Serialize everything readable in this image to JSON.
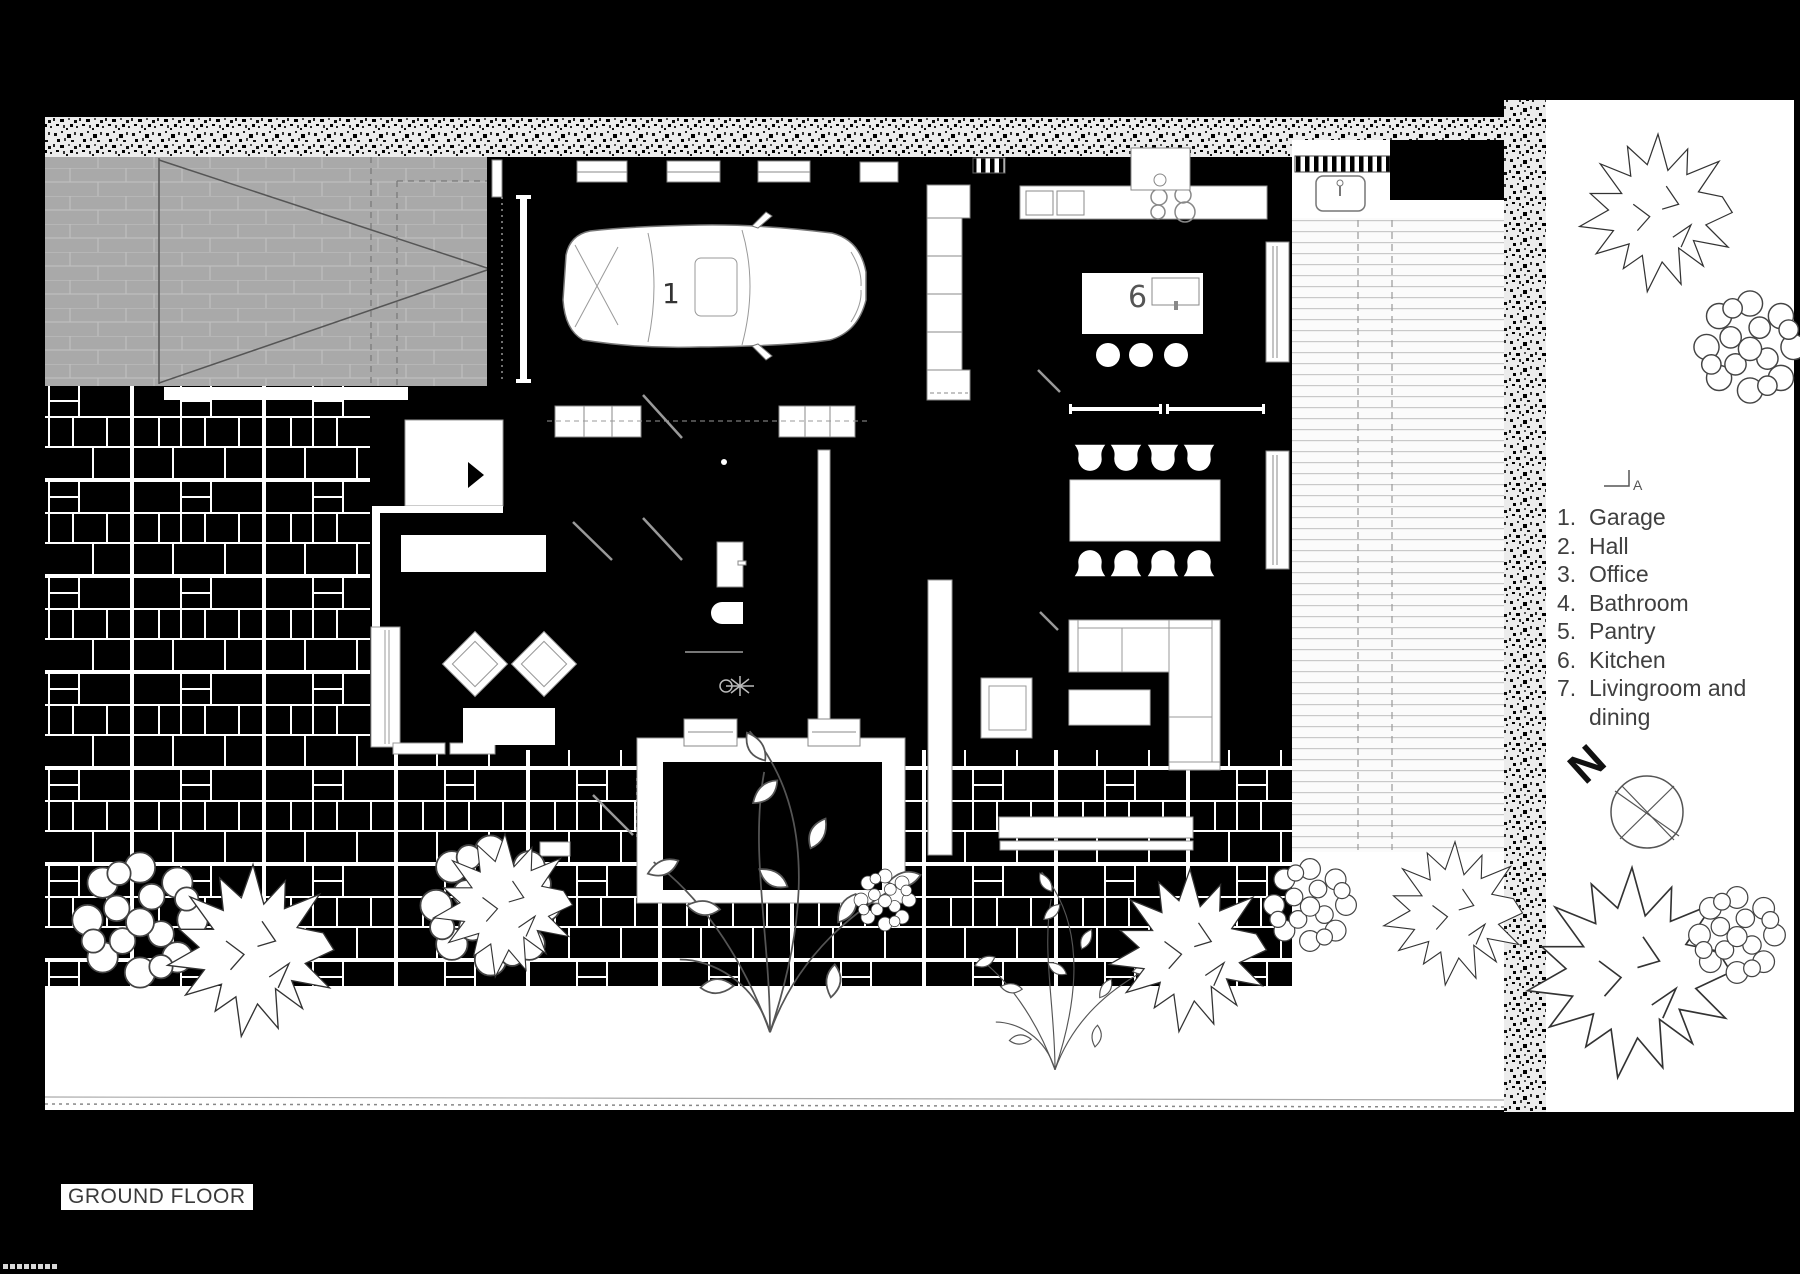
{
  "title": "GROUND FLOOR",
  "legend": {
    "items": [
      {
        "num": "1.",
        "label": "Garage"
      },
      {
        "num": "2.",
        "label": "Hall"
      },
      {
        "num": "3.",
        "label": "Office"
      },
      {
        "num": "4.",
        "label": "Bathroom"
      },
      {
        "num": "5.",
        "label": "Pantry"
      },
      {
        "num": "6.",
        "label": "Kitchen"
      },
      {
        "num": "7.",
        "label": "Livingroom and dining"
      }
    ]
  },
  "plan": {
    "room_numbers": {
      "garage": "1",
      "kitchen": "6"
    }
  },
  "compass": {
    "label": "N"
  },
  "section_marker": {
    "label": "A"
  },
  "colors": {
    "background": "#000000",
    "paper": "#ffffff",
    "driveway": "#a9a9a9",
    "text": "#3d3d3d"
  }
}
